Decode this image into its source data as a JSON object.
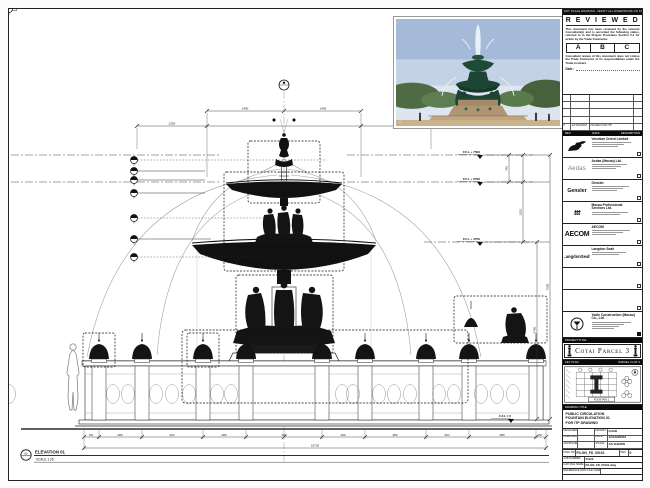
{
  "sheet": {
    "top_note": "DO NOT SCALE DRAWING. VERIFY ALL DIMENSIONS ON SITE."
  },
  "reviewed": {
    "title": "R E V I E W E D",
    "para1": "This document has been reviewed by the relevant Consultant(s) and is accorded the following status, referred to in the Project Procedure Section 5.4 for action by the Trade Contractor.",
    "options": [
      "A",
      "B",
      "C"
    ],
    "para2": "Consultant review of this document does not relieve the Trade Contractor of its responsibilities under the Trade Contract.",
    "date_label": "Date :"
  },
  "revisions": {
    "header": {
      "rev": "REV",
      "date": "DATE",
      "desc": "DESCRIPTION"
    },
    "rows": [
      {
        "rev": "0",
        "date": "12/JAN/2016",
        "desc": "ISSUED FOR ITP"
      }
    ]
  },
  "consultants": [
    {
      "name": "Venetian Orient Limited",
      "logo_text": ""
    },
    {
      "name": "Aedas (Macau) Ltd.",
      "logo_text": "Aedas"
    },
    {
      "name": "Gensler",
      "logo_text": "Gensler"
    },
    {
      "name": "Macau Professional Services Ltd.",
      "logo_text": "ttt"
    },
    {
      "name": "AECOM",
      "logo_text": "AECOM"
    },
    {
      "name": "Langdon Seah",
      "logo_text": "LangdonSeah"
    }
  ],
  "contractor": {
    "name": "Yadie Construction (Macau) Co., Ltd."
  },
  "project": {
    "band": "PROJECT TITLE",
    "title": "Cotai Parcel 3"
  },
  "keyplan": {
    "band": "KEY PLAN",
    "parcel": "PARCEL 3 LOT 2",
    "area_label": "FOUNTAIN 1"
  },
  "drawing_title": {
    "band": "DRAWING TITLE",
    "lines": [
      "PUBLIC CIRCULATION",
      "FOUNTAIN ELEVATION 01",
      "FOR ITP DRAWING"
    ]
  },
  "approval": {
    "designed_label": "DESIGNED",
    "designed": "",
    "drawn_label": "DRAWN",
    "drawn": "CHAD",
    "checked_label": "CHECKED",
    "checked": "-",
    "date_label": "DATE",
    "date": "12/JAN/2016",
    "approved_label": "APPROVED",
    "approved": "-",
    "scale_label": "SCALE",
    "scale": "AS SHOWN",
    "dwg_label": "DWG NO.",
    "dwg_no": "P3-GN_FD_05101",
    "rev_label": "REV",
    "rev": "0",
    "job_label": "JOB NUMBER",
    "job": "51123",
    "cad_label": "CAD FILE NAME",
    "cad": "P3-GN_FD_05101.dwg",
    "ref_label": "REFERENCE DWG FILE NAME",
    "ref": ""
  },
  "elevation": {
    "tag": "01",
    "label": "ELEVATION 01",
    "scale": "SCALE 1:25",
    "levels": {
      "l1": "F.F.L + 7500",
      "l2": "F.F.L + 6760",
      "l3": "F.F.L + 4750",
      "l0": "F.F.L ± 0"
    },
    "dims": {
      "top_left": "1490",
      "top_right": "1490",
      "top2_left": "2250",
      "top2_right": "2250",
      "r1": "740",
      "r2": "2010",
      "r3": "4750",
      "overall_h": "7500",
      "bottom": [
        "450",
        "1850",
        "2610",
        "1850",
        "1600",
        "1600",
        "1850",
        "2610",
        "1850",
        "450"
      ],
      "overall_w": "16720"
    }
  },
  "photo": {
    "credit": "©"
  }
}
